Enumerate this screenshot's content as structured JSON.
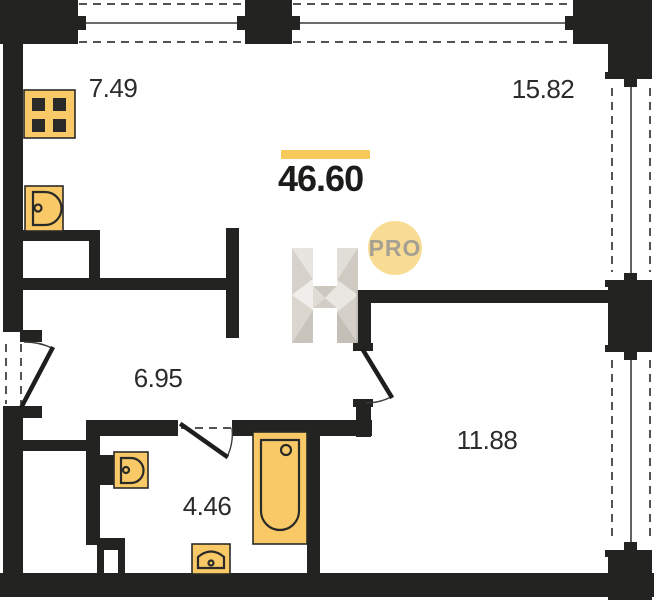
{
  "plan": {
    "total_area": "46.60",
    "badge_label": "PRO",
    "rooms": [
      {
        "name": "kitchen",
        "area": "7.49"
      },
      {
        "name": "living-room",
        "area": "15.82"
      },
      {
        "name": "hallway",
        "area": "6.95"
      },
      {
        "name": "bathroom",
        "area": "4.46"
      },
      {
        "name": "bedroom",
        "area": "11.88"
      }
    ],
    "fixtures": [
      "stove",
      "kitchen-sink",
      "bath-sink",
      "toilet",
      "bathtub"
    ],
    "icons": [
      "window-icon",
      "door-swing-icon",
      "h-logo-watermark"
    ],
    "colors": {
      "wall": "#232321",
      "fixture": "#F8C966",
      "accent": "#F6C95A",
      "badge-bg": "#F8DC93",
      "badge-text": "#A5A093",
      "label": "#2B2B29"
    }
  }
}
